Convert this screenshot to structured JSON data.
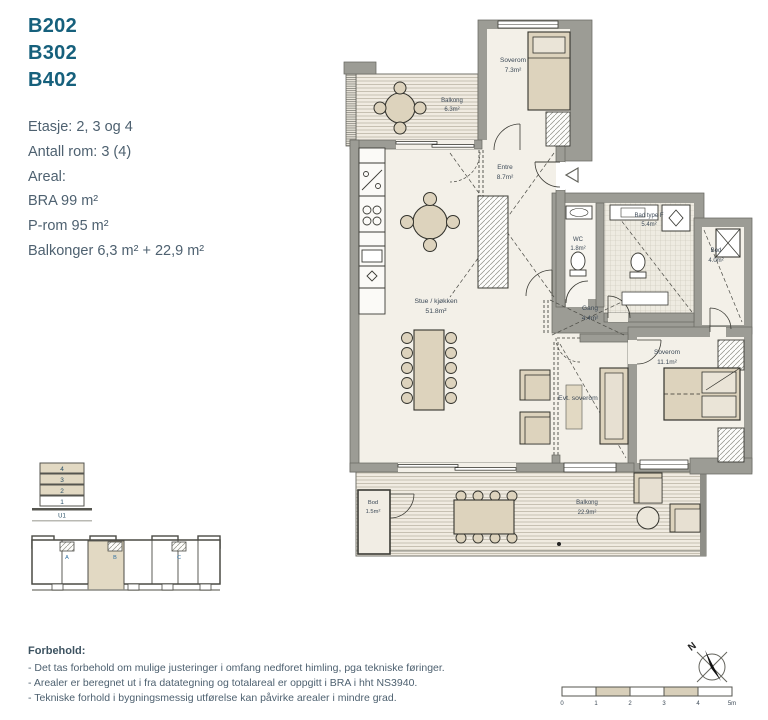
{
  "info_panel": {
    "unit_ids": [
      "B202",
      "B302",
      "B402"
    ],
    "etasje": "Etasje: 2, 3 og 4",
    "antall_rom": "Antall rom: 3 (4)",
    "areal_label": "Areal:",
    "bra": "BRA 99 m²",
    "p_rom": "P-rom 95 m²",
    "balkonger": "Balkonger 6,3 m² + 22,9 m²"
  },
  "floor_plan": {
    "rooms": {
      "balkong_top": {
        "name": "Balkong",
        "area": "6.3m²"
      },
      "soverom_top": {
        "name": "Soverom",
        "area": "7.3m²"
      },
      "entre": {
        "name": "Entre",
        "area": "8.7m²"
      },
      "wc": {
        "name": "WC",
        "area": "1.8m²"
      },
      "bad": {
        "name": "Bad type F",
        "area": "5.4m²"
      },
      "bod_right": {
        "name": "Bod",
        "area": "4.0m²"
      },
      "gang": {
        "name": "Gang",
        "area": "4.4m²"
      },
      "stue": {
        "name": "Stue / kjøkken",
        "area": "51.8m²"
      },
      "evt_soverom": {
        "name": "Evt. soverom"
      },
      "soverom_right": {
        "name": "Soverom",
        "area": "11.1m²"
      },
      "bod_balkong": {
        "name": "Bod",
        "area": "1.5m²"
      },
      "balkong_bottom": {
        "name": "Balkong",
        "area": "22.9m²"
      }
    }
  },
  "section_diagram": {
    "floors": [
      "4",
      "3",
      "2",
      "1"
    ],
    "basement_label": "U1"
  },
  "key_plan": {
    "entrance_labels": [
      "A",
      "B",
      "C"
    ]
  },
  "compass": {
    "north_label": "N"
  },
  "scale_bar": {
    "ticks": [
      "0",
      "1",
      "2",
      "3",
      "4",
      "5m"
    ]
  },
  "disclaimer": {
    "title": "Forbehold:",
    "lines": [
      "- Det tas forbehold om mulige justeringer i omfang nedforet himling, pga tekniske føringer.",
      "- Arealer er beregnet ut i fra datategning og totalareal er oppgitt i BRA i hht NS3940.",
      "- Tekniske forhold i bygningsmessig utførelse kan påvirke arealer i mindre grad."
    ]
  },
  "colors": {
    "accent_teal": "#16607c",
    "body_text": "#4e6170",
    "wall_gray": "#9c9c95",
    "room_fill": "#f3f0e8",
    "furniture_fill": "#ddd3bd",
    "highlight_beige": "#e2d9c3"
  }
}
